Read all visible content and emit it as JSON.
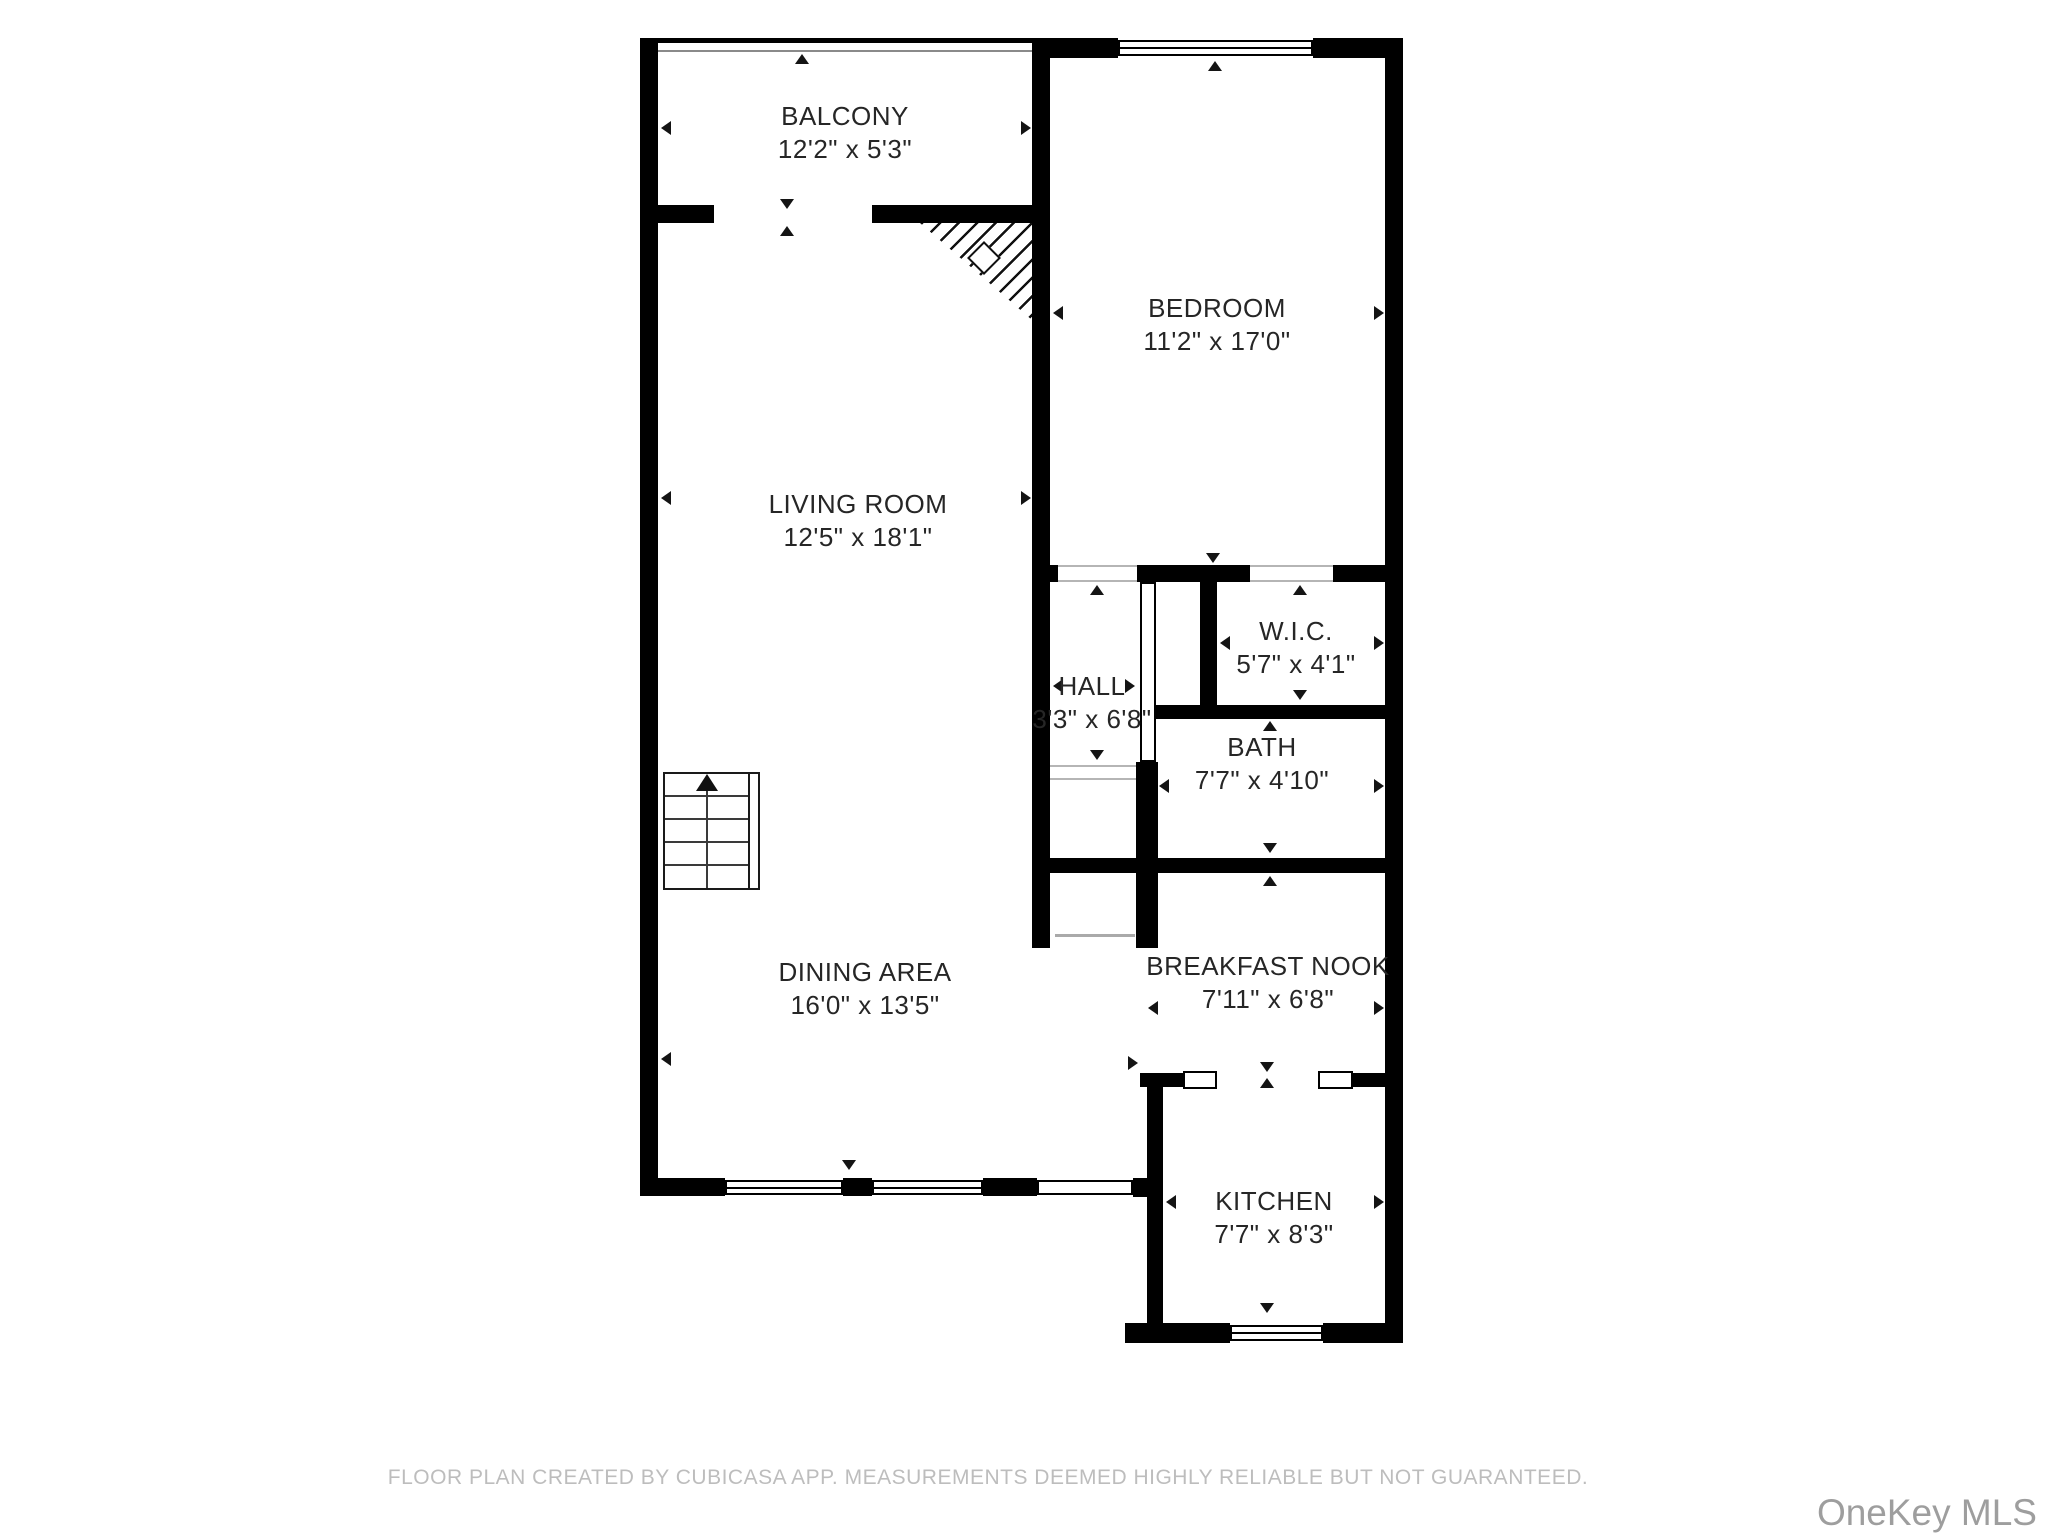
{
  "floorplan": {
    "rooms": {
      "balcony": {
        "name": "BALCONY",
        "dims": "12'2\" x 5'3\""
      },
      "bedroom": {
        "name": "BEDROOM",
        "dims": "11'2\" x 17'0\""
      },
      "living_room": {
        "name": "LIVING ROOM",
        "dims": "12'5\" x 18'1\""
      },
      "hall": {
        "name": "HALL",
        "dims": "3'3\" x 6'8\""
      },
      "wic": {
        "name": "W.I.C.",
        "dims": "5'7\" x 4'1\""
      },
      "bath": {
        "name": "BATH",
        "dims": "7'7\" x 4'10\""
      },
      "dining_area": {
        "name": "DINING AREA",
        "dims": "16'0\" x 13'5\""
      },
      "breakfast_nook": {
        "name": "BREAKFAST NOOK",
        "dims": "7'11\" x 6'8\""
      },
      "kitchen": {
        "name": "KITCHEN",
        "dims": "7'7\" x 8'3\""
      }
    },
    "colors": {
      "wall": "#000000",
      "thin_line": "#aaaaaa",
      "marker": "#141414",
      "label_text": "#262626",
      "footer_text": "#bdbdbd",
      "watermark_text": "#9e9e9e"
    }
  },
  "footer": {
    "disclaimer": "FLOOR PLAN CREATED BY CUBICASA APP. MEASUREMENTS DEEMED HIGHLY RELIABLE BUT NOT GUARANTEED."
  },
  "watermark": {
    "text": "OneKey MLS"
  }
}
